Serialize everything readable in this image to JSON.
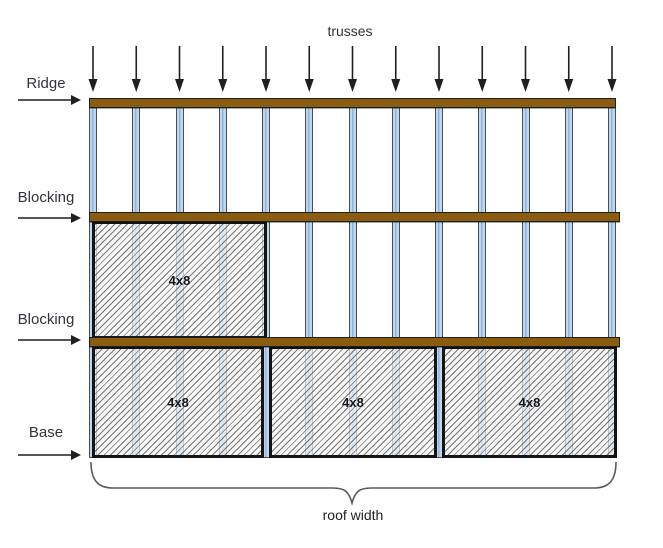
{
  "diagram": {
    "top_label": "trusses",
    "left_labels": [
      {
        "label": "Ridge"
      },
      {
        "label": "Blocking"
      },
      {
        "label": "Blocking"
      },
      {
        "label": "Base"
      }
    ],
    "panels": [
      {
        "label": "4x8",
        "position": "middle-row-left"
      },
      {
        "label": "4x8",
        "position": "base-row-left"
      },
      {
        "label": "4x8",
        "position": "base-row-center"
      },
      {
        "label": "4x8",
        "position": "base-row-right"
      }
    ],
    "bottom_label": "roof width",
    "truss_count": 13,
    "load_arrow_count": 13,
    "colors": {
      "bar_brown": "#8a5c10",
      "bar_border": "#1f1f1f",
      "truss_fill": "#bcd8f0",
      "truss_stripe": "#8fb5de",
      "truss_border": "#4d4d4d",
      "panel_border": "#141414",
      "panel_label_color": "#16161e",
      "label_color": "#33333d",
      "arrow_color": "#1f1f1f",
      "brace_color": "#5a5a5a"
    }
  }
}
